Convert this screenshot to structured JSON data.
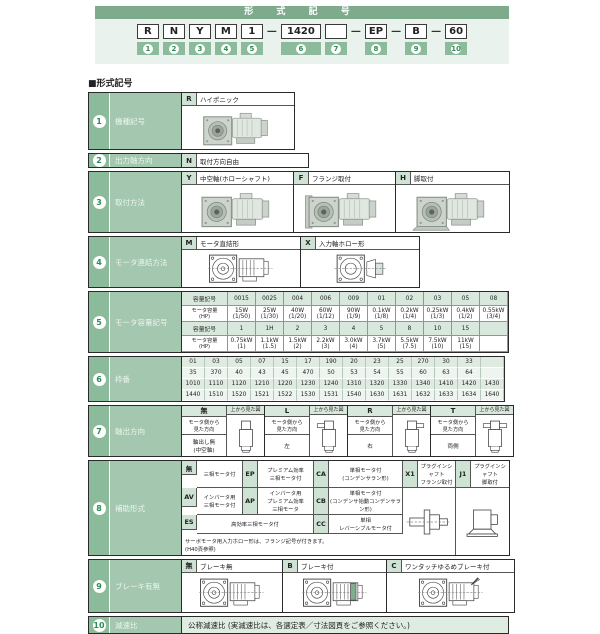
{
  "colors": {
    "accent_green": "#7fab8d",
    "badge_green": "#8cbb9c",
    "light_green": "#cfe3d4",
    "panel_green": "#e9f2ec"
  },
  "header": {
    "banner": "形 式 記 号",
    "dash": "—",
    "codes": [
      "R",
      "N",
      "Y",
      "M",
      "1",
      "1420",
      "",
      "EP",
      "B",
      "60"
    ],
    "badges": [
      "1",
      "2",
      "3",
      "4",
      "5",
      "6",
      "7",
      "8",
      "9",
      "10"
    ]
  },
  "section_title": "■形式記号",
  "rows": {
    "r1": {
      "no": "1",
      "label": "機種記号",
      "code": "R",
      "desc": "ハイポニック",
      "image": "hyponic-gearmotor-photo"
    },
    "r2": {
      "no": "2",
      "label": "出力軸方向",
      "code": "N",
      "desc": "取付方向自由"
    },
    "r3": {
      "no": "3",
      "label": "取付方法",
      "options": [
        {
          "code": "Y",
          "desc": "中空軸(ホローシャフト)",
          "image": "hollow-shaft-photo"
        },
        {
          "code": "F",
          "desc": "フランジ取付",
          "image": "flange-mount-photo"
        },
        {
          "code": "H",
          "desc": "脚取付",
          "image": "foot-mount-photo"
        }
      ]
    },
    "r4": {
      "no": "4",
      "label": "モータ連結方法",
      "options": [
        {
          "code": "M",
          "desc": "モータ直結形",
          "image": "motor-direct-drawing"
        },
        {
          "code": "X",
          "desc": "入力軸ホロー形",
          "image": "input-hollow-drawing"
        }
      ]
    },
    "r5": {
      "no": "5",
      "label": "モータ容量記号",
      "row_label_code": "容量記号",
      "row_label_cap": "モータ容量\n(HP)",
      "codes1": [
        "0015",
        "0025",
        "004",
        "006",
        "009",
        "01",
        "02",
        "03",
        "05",
        "08"
      ],
      "caps1": [
        "15W\n(1/50)",
        "25W\n(1/30)",
        "40W\n(1/20)",
        "60W\n(1/12)",
        "90W\n(1/9)",
        "0.1kW\n(1/8)",
        "0.2kW\n(1/4)",
        "0.25kW\n(1/3)",
        "0.4kW\n(1/2)",
        "0.55kW\n(3/4)"
      ],
      "codes2": [
        "1",
        "1H",
        "2",
        "3",
        "4",
        "5",
        "8",
        "10",
        "15",
        ""
      ],
      "caps2": [
        "0.75kW\n(1)",
        "1.1kW\n(1.5)",
        "1.5kW\n(2)",
        "2.2kW\n(3)",
        "3.0kW\n(4)",
        "3.7kW\n(5)",
        "5.5kW\n(7.5)",
        "7.5kW\n(10)",
        "11kW\n(15)",
        ""
      ]
    },
    "r6": {
      "no": "6",
      "label": "枠番",
      "row1": [
        "01",
        "03",
        "05",
        "07",
        "15",
        "17",
        "190",
        "20",
        "23",
        "25",
        "270",
        "30",
        "33",
        ""
      ],
      "row2": [
        "35",
        "370",
        "40",
        "43",
        "45",
        "470",
        "50",
        "53",
        "54",
        "55",
        "60",
        "63",
        "64",
        ""
      ],
      "row3": [
        "1010",
        "1110",
        "1120",
        "1210",
        "1220",
        "1230",
        "1240",
        "1310",
        "1320",
        "1330",
        "1340",
        "1410",
        "1420",
        "1430"
      ],
      "row4": [
        "1440",
        "1510",
        "1520",
        "1521",
        "1522",
        "1530",
        "1531",
        "1540",
        "1630",
        "1631",
        "1632",
        "1633",
        "1634",
        "1640"
      ]
    },
    "r7": {
      "no": "7",
      "label": "軸出方向",
      "fig_header": "上から見た図",
      "view_label": "モータ側から\n見た方向",
      "options": [
        {
          "code": "無",
          "dir": "軸出し無\n(中空軸)",
          "image": "top-view-no-shaft"
        },
        {
          "code": "L",
          "dir": "左",
          "image": "top-view-left-shaft"
        },
        {
          "code": "R",
          "dir": "右",
          "image": "top-view-right-shaft"
        },
        {
          "code": "T",
          "dir": "両側",
          "image": "top-view-both-shafts"
        }
      ]
    },
    "r8": {
      "no": "8",
      "label": "補助形式",
      "a1": {
        "code": "無",
        "desc": "三相モータ付"
      },
      "a2": {
        "code": "EP",
        "desc": "プレミアム効率\n三相モータ付"
      },
      "a3": {
        "code": "CA",
        "desc": "単相モータ付\n(コンデンサラン形)"
      },
      "a4": {
        "code": "X1",
        "desc": "プラグインシャフト\nフランジ取付"
      },
      "a5": {
        "code": "J1",
        "desc": "プラグインシャフト\n脚取付"
      },
      "b1": {
        "code": "AV",
        "desc": "インバータ用\n三相モータ付"
      },
      "b2": {
        "code": "AP",
        "desc": "インバータ用\nプレミアム効率\n三相モータ"
      },
      "b3": {
        "code": "CB",
        "desc": "単相モータ付\n(コンデンサ始動コンデンサラン形)"
      },
      "c1": {
        "code": "ES",
        "desc": "高効率三相モータ付"
      },
      "c2": {
        "code": "CC",
        "desc": "単相\nレバーシブルモータ付"
      },
      "note": "サーボモータ用入力ホロー形は、フランジ記号が付きます。\n(H40頁参照)",
      "figs": [
        "plug-in-shaft-flange-drawing",
        "plug-in-shaft-foot-drawing"
      ]
    },
    "r9": {
      "no": "9",
      "label": "ブレーキ有無",
      "options": [
        {
          "code": "無",
          "desc": "ブレーキ無",
          "image": "no-brake-drawing"
        },
        {
          "code": "B",
          "desc": "ブレーキ付",
          "image": "brake-drawing"
        },
        {
          "code": "C",
          "desc": "ワンタッチゆるめブレーキ付",
          "image": "one-touch-release-brake-drawing"
        }
      ]
    },
    "r10": {
      "no": "10",
      "label": "減速比",
      "desc": "公称減速比 (実減速比は、各選定表／寸法図頁をご参照ください。)"
    }
  }
}
